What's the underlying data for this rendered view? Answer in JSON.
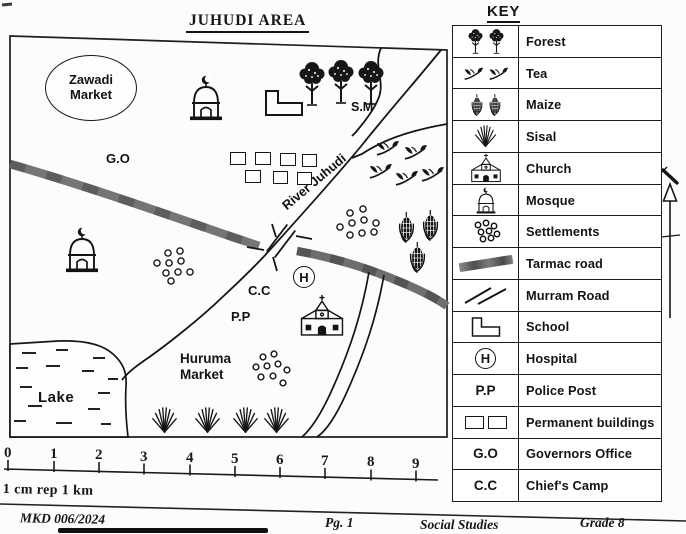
{
  "map": {
    "title": "JUHUDI AREA",
    "labels": {
      "zawadi1": "Zawadi",
      "zawadi2": "Market",
      "go": "G.O",
      "sm": "S.M",
      "river": "River Juhudi",
      "cc": "C.C",
      "pp": "P.P",
      "hospital": "H",
      "huruma1": "Huruma",
      "huruma2": "Market",
      "lake": "Lake"
    },
    "scale": {
      "ticks": [
        "0",
        "1",
        "2",
        "3",
        "4",
        "5",
        "6",
        "7",
        "8",
        "9"
      ],
      "caption": "1 cm rep 1 km"
    }
  },
  "key": {
    "title": "KEY",
    "rows": [
      {
        "symbol": "forest-trees-icon",
        "label": "Forest"
      },
      {
        "symbol": "tea-sprig-icon",
        "label": "Tea"
      },
      {
        "symbol": "maize-cob-icon",
        "label": "Maize"
      },
      {
        "symbol": "sisal-plant-icon",
        "label": "Sisal"
      },
      {
        "symbol": "church-icon",
        "label": "Church"
      },
      {
        "symbol": "mosque-icon",
        "label": "Mosque"
      },
      {
        "symbol": "settlements-circles-icon",
        "label": "Settlements"
      },
      {
        "symbol": "tarmac-road-band-icon",
        "label": "Tarmac road"
      },
      {
        "symbol": "murram-road-lines-icon",
        "label": "Murram Road"
      },
      {
        "symbol": "school-lshape-icon",
        "label": "School"
      },
      {
        "symbol": "hospital-circle-icon",
        "symbol_text": "H",
        "label": "Hospital"
      },
      {
        "symbol": "text",
        "symbol_text": "P.P",
        "label": "Police Post"
      },
      {
        "symbol": "permanent-buildings-icon",
        "label": "Permanent buildings"
      },
      {
        "symbol": "text",
        "symbol_text": "G.O",
        "label": "Governors Office"
      },
      {
        "symbol": "text",
        "symbol_text": "C.C",
        "label": "Chief's Camp"
      }
    ]
  },
  "footer": {
    "code": "MKD 006/2024",
    "page": "Pg. 1",
    "subject": "Social Studies",
    "grade": "Grade 8"
  },
  "colors": {
    "ink": "#151515",
    "tarmac_gray": "#6e6e6e",
    "paper": "#fcfcfa"
  }
}
